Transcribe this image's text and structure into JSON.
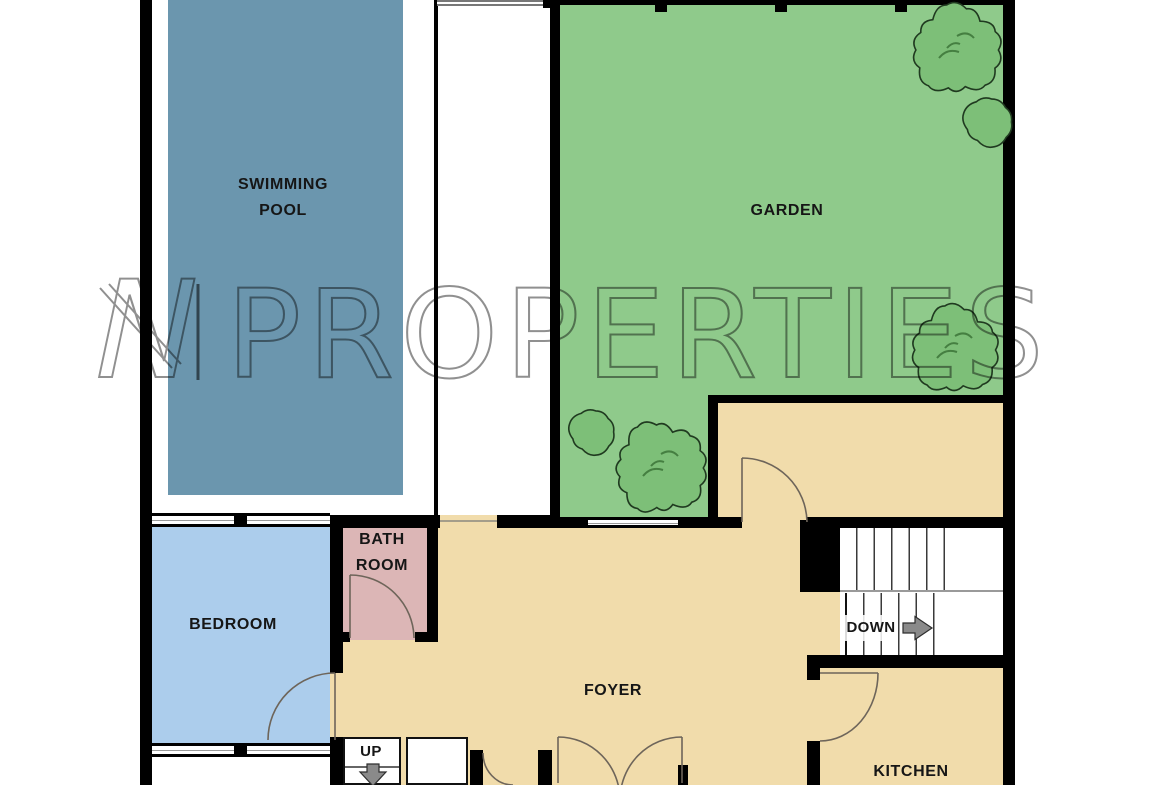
{
  "brand": {
    "letter": "N",
    "divider": "|",
    "name": "PROPERTIES"
  },
  "rooms": {
    "swimming_pool": {
      "line1": "SWIMMING",
      "line2": "POOL"
    },
    "garden": {
      "label": "GARDEN"
    },
    "bedroom": {
      "label": "BEDROOM"
    },
    "bathroom": {
      "line1": "BATH",
      "line2": "ROOM"
    },
    "foyer": {
      "label": "FOYER"
    },
    "kitchen": {
      "label": "KITCHEN"
    }
  },
  "stairs": {
    "down": "DOWN",
    "up": "UP"
  },
  "colors": {
    "pool": "#6b96ae",
    "garden": "#8fca8b",
    "bedroom": "#accdec",
    "bathroom": "#dcb6b6",
    "floor": "#f1dcab",
    "wall": "#000000",
    "watermark": "#7d7d7d",
    "tree": "#7dbf78",
    "arrow": "#8a8a8a"
  }
}
